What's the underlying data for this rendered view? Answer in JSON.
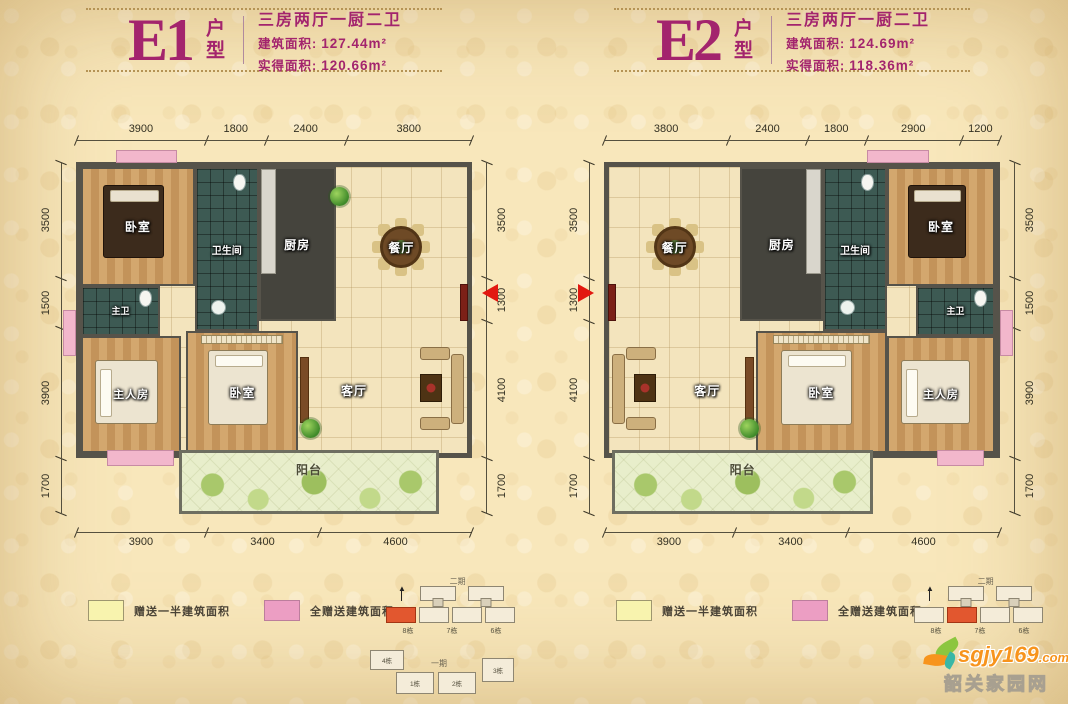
{
  "page": {
    "background": "#f8e7bb",
    "accent": "#a3246d",
    "arrow_color": "#e21810"
  },
  "legend": {
    "half_label": "赠送一半建筑面积",
    "half_color": "#f8f3ae",
    "full_label": "全赠送建筑面积",
    "full_color": "#ec9ec3"
  },
  "watermark": {
    "site": "sgjy169",
    "tld": ".com",
    "name": "韶关家园网"
  },
  "siteplan": {
    "phase2_label": "二期",
    "phase1_label": "一期",
    "side_buildings": [
      "8栋",
      "7栋",
      "6栋"
    ],
    "bottom_buildings": [
      "4栋",
      "1栋",
      "2栋",
      "3栋"
    ]
  },
  "units": [
    {
      "code": "E1",
      "suffix": "户型",
      "spec": "三房两厅一厨二卫",
      "built_label": "建筑面积:",
      "built_value": "127.44m²",
      "net_label": "实得面积:",
      "net_value": "120.66m²",
      "dims": {
        "top": [
          "3900",
          "1800",
          "2400",
          "3800"
        ],
        "bottom": [
          "3900",
          "3400",
          "4600"
        ],
        "left": [
          "3500",
          "1500",
          "3900",
          "1700"
        ],
        "right": [
          "3500",
          "1300",
          "4100",
          "1700"
        ]
      },
      "rooms": {
        "bedroom_top": "卧室",
        "bathroom": "卫生间",
        "kitchen": "厨房",
        "dining": "餐厅",
        "master_bath": "主卫",
        "master_bedroom": "主人房",
        "bedroom_mid": "卧室",
        "living": "客厅",
        "balcony": "阳台"
      }
    },
    {
      "code": "E2",
      "suffix": "户型",
      "spec": "三房两厅一厨二卫",
      "built_label": "建筑面积:",
      "built_value": "124.69m²",
      "net_label": "实得面积:",
      "net_value": "118.36m²",
      "dims": {
        "top": [
          "3800",
          "2400",
          "1800",
          "2900",
          "1200"
        ],
        "bottom": [
          "3900",
          "3400",
          "4600"
        ],
        "left": [
          "3500",
          "1300",
          "4100",
          "1700"
        ],
        "right": [
          "3500",
          "1500",
          "3900",
          "1700"
        ]
      },
      "rooms": {
        "dining": "餐厅",
        "kitchen": "厨房",
        "bathroom": "卫生间",
        "bedroom_top": "卧室",
        "master_bath": "主卫",
        "living": "客厅",
        "bedroom_mid": "卧室",
        "master_bedroom": "主人房",
        "balcony": "阳台"
      }
    }
  ]
}
